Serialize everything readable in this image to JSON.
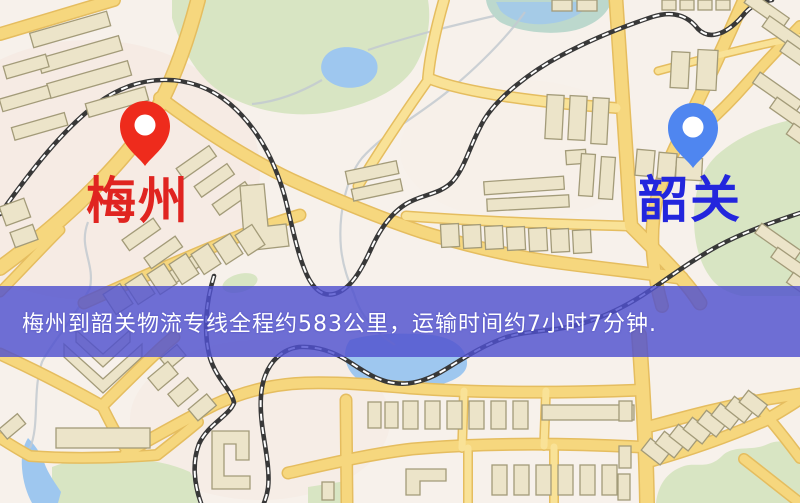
{
  "map": {
    "origin_marker": {
      "label": "梅州",
      "pin_color": "#ee2b1c",
      "label_color": "#e02420",
      "pin_style": "location-pin"
    },
    "destination_marker": {
      "label": "韶关",
      "pin_color": "#4f86f0",
      "label_color": "#2326dd",
      "pin_style": "location-pin"
    },
    "banner": {
      "text": "梅州到韶关物流专线全程约583公里，运输时间约7小时7分钟.",
      "background_color": "#4f50ce",
      "text_color": "#ffffff"
    },
    "route": {
      "origin": "梅州",
      "destination": "韶关",
      "distance_text": "约583公里",
      "duration_text": "约7小时7分钟"
    },
    "palette": {
      "background": "#f7f1eb",
      "road": "#f6d77e",
      "road_casing": "#e5bd5f",
      "railway": "#383838",
      "park": "#d8e5c3",
      "water": "#9ec7ef",
      "building": "#ece4c9"
    }
  }
}
